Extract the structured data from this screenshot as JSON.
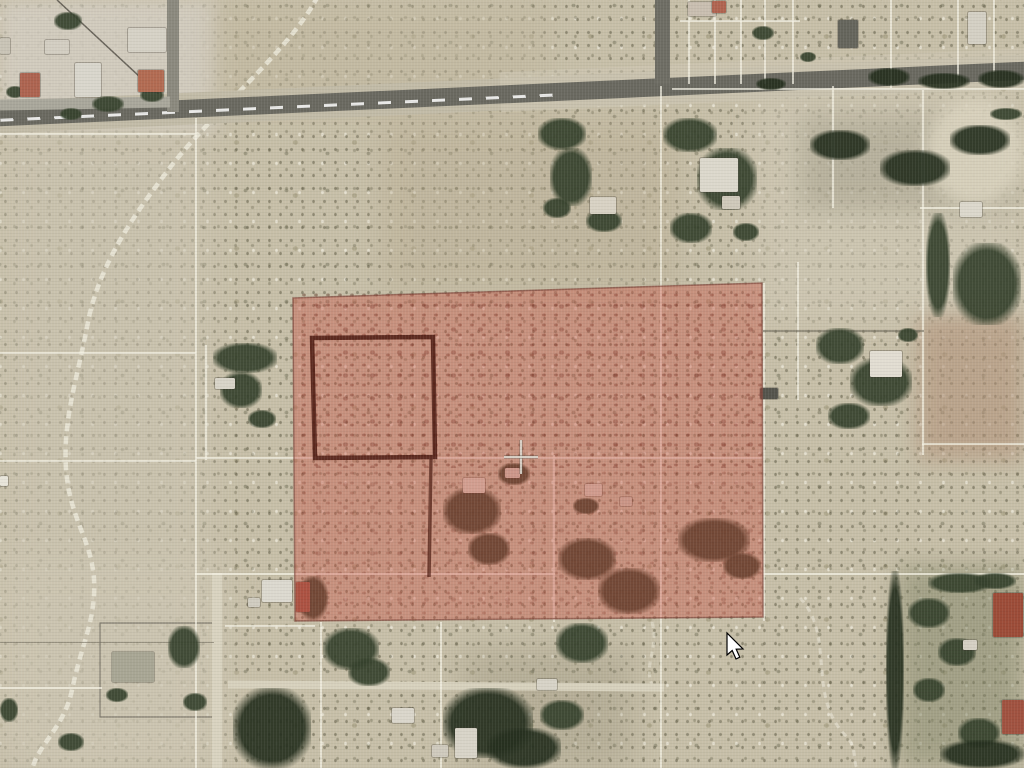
{
  "screen": {
    "width": 1024,
    "height": 768
  },
  "map": {
    "colors": {
      "desert_base": "#c7bfa8",
      "road": "#6a6960",
      "road_shoulder": "#c2bba7",
      "parcel_line": "#f4f1e3",
      "parcel_line_dark": "#6f6a5c",
      "tree": "#36422d",
      "tree_dark": "#26301f",
      "wash": "#ebe7d8",
      "selection_fill": "#c7483a",
      "selection_stroke": "#7a4036",
      "bold_outline": "#4a190f",
      "crosshair_light": "#f5f3ea",
      "crosshair_dark": "#4a483f",
      "cursor_fill": "#ffffff",
      "cursor_stroke": "#000000"
    },
    "patches": [
      [
        0,
        0,
        218,
        132,
        "#d3cdc0",
        0.9,
        8,
        0,
        0
      ],
      [
        210,
        0,
        340,
        118,
        "#c1b79e",
        0.5,
        12,
        0,
        0
      ],
      [
        0,
        128,
        212,
        645,
        "#ccc5b2",
        0.55,
        16,
        0,
        0
      ],
      [
        380,
        118,
        300,
        175,
        "#b8ab90",
        0.4,
        14,
        0,
        0
      ],
      [
        755,
        88,
        270,
        235,
        "#d1cab7",
        0.55,
        16,
        0,
        0
      ],
      [
        800,
        115,
        215,
        95,
        "#8a8672",
        0.3,
        12,
        0,
        0
      ],
      [
        918,
        315,
        106,
        145,
        "#b2937a",
        0.6,
        10,
        0,
        0
      ],
      [
        925,
        98,
        100,
        108,
        "#dcd5c0",
        0.85,
        8,
        1,
        0
      ],
      [
        898,
        566,
        126,
        202,
        "#7f8365",
        0.5,
        12,
        0,
        0
      ],
      [
        462,
        648,
        170,
        120,
        "#97917a",
        0.35,
        16,
        0,
        0
      ],
      [
        0,
        556,
        232,
        212,
        "#cfc8b4",
        0.45,
        16,
        0,
        0
      ],
      [
        298,
        290,
        464,
        178,
        "",
        0.85,
        0,
        0,
        1
      ],
      [
        298,
        468,
        464,
        150,
        "",
        0.55,
        0,
        0,
        1
      ]
    ],
    "roads": [
      {
        "x": -10,
        "y": 78,
        "w": 1044,
        "h": 32,
        "c": "#c2bba7",
        "rot": -2.6
      },
      {
        "x": 500,
        "y": 60,
        "w": 540,
        "h": 40,
        "c": "#cdc6b2",
        "rot": -2.6,
        "op": 0.6
      },
      {
        "x": -10,
        "y": 84.5,
        "w": 1044,
        "h": 18,
        "c": "#6a6960",
        "rot": -2.6
      },
      {
        "x": 0,
        "y": 105.5,
        "w": 560,
        "h": 3,
        "rot": -2.6,
        "dash": true
      },
      {
        "x": 655,
        "y": 0,
        "w": 15,
        "h": 84,
        "c": "#6e6d64"
      },
      {
        "x": 167,
        "y": 0,
        "w": 12,
        "h": 112,
        "c": "#8b897e"
      },
      {
        "x": 0,
        "y": 98,
        "w": 170,
        "h": 11,
        "c": "#a9a79b",
        "rot": -1
      },
      {
        "x": 228,
        "y": 682,
        "w": 436,
        "h": 8,
        "c": "#d7d1bd",
        "rot": 0.4
      },
      {
        "x": 212,
        "y": 573,
        "w": 10,
        "h": 195,
        "c": "#d9d3c0"
      }
    ],
    "parcel_lines": [
      [
        195,
        118,
        1.5,
        650,
        "l"
      ],
      [
        660,
        86,
        1.5,
        682,
        "l"
      ],
      [
        553,
        455,
        1.5,
        167,
        "l"
      ],
      [
        763,
        283,
        1.5,
        338,
        "l"
      ],
      [
        797,
        262,
        1.5,
        138,
        "l"
      ],
      [
        922,
        90,
        1.5,
        365,
        "l"
      ],
      [
        832,
        86,
        1.5,
        122,
        "l"
      ],
      [
        688,
        0,
        1.5,
        84,
        "l"
      ],
      [
        714,
        0,
        1.5,
        84,
        "l"
      ],
      [
        740,
        0,
        1.5,
        84,
        "l"
      ],
      [
        764,
        0,
        1.5,
        84,
        "l"
      ],
      [
        792,
        0,
        1.5,
        84,
        "l"
      ],
      [
        890,
        0,
        1.5,
        88,
        "l"
      ],
      [
        957,
        0,
        1.5,
        86,
        "l"
      ],
      [
        993,
        0,
        1.5,
        86,
        "l"
      ],
      [
        320,
        622,
        1.5,
        146,
        "l"
      ],
      [
        440,
        622,
        1.5,
        146,
        "l"
      ],
      [
        205,
        345,
        1.5,
        115,
        "l"
      ],
      [
        0,
        133,
        196,
        1.5,
        "l"
      ],
      [
        0,
        352,
        196,
        1.5,
        "l"
      ],
      [
        0,
        460,
        196,
        1.5,
        "l"
      ],
      [
        196,
        457,
        567,
        1.5,
        "l"
      ],
      [
        195,
        573,
        360,
        1.5,
        "l"
      ],
      [
        763,
        573,
        261,
        1.5,
        "l"
      ],
      [
        672,
        88,
        352,
        1.5,
        "l"
      ],
      [
        680,
        20,
        120,
        1.5,
        "l"
      ],
      [
        920,
        207,
        104,
        1.5,
        "l"
      ],
      [
        922,
        443,
        102,
        1.5,
        "l"
      ],
      [
        225,
        625,
        90,
        1.5,
        "l"
      ],
      [
        0,
        687,
        102,
        1.5,
        "l"
      ],
      [
        763,
        330,
        161,
        1.5,
        "d"
      ],
      [
        0,
        642,
        214,
        1,
        "d"
      ]
    ],
    "trees": [
      [
        54,
        12,
        28,
        18,
        0
      ],
      [
        92,
        96,
        32,
        16,
        0
      ],
      [
        140,
        88,
        24,
        14,
        0
      ],
      [
        6,
        86,
        18,
        12,
        0
      ],
      [
        60,
        108,
        22,
        12,
        0
      ],
      [
        213,
        343,
        64,
        30,
        0
      ],
      [
        220,
        372,
        42,
        36,
        0
      ],
      [
        248,
        410,
        28,
        18,
        0
      ],
      [
        538,
        118,
        48,
        32,
        0
      ],
      [
        550,
        148,
        42,
        58,
        0
      ],
      [
        586,
        210,
        36,
        22,
        0
      ],
      [
        543,
        198,
        28,
        20,
        0
      ],
      [
        663,
        118,
        54,
        34,
        0
      ],
      [
        697,
        148,
        60,
        62,
        0
      ],
      [
        670,
        213,
        42,
        30,
        0
      ],
      [
        733,
        223,
        26,
        18,
        0
      ],
      [
        816,
        328,
        48,
        36,
        0
      ],
      [
        850,
        358,
        62,
        48,
        0
      ],
      [
        828,
        403,
        42,
        26,
        0
      ],
      [
        898,
        328,
        20,
        14,
        0
      ],
      [
        926,
        213,
        24,
        104,
        0
      ],
      [
        953,
        243,
        68,
        82,
        0
      ],
      [
        990,
        108,
        32,
        12,
        0
      ],
      [
        868,
        68,
        42,
        18,
        1
      ],
      [
        918,
        73,
        52,
        16,
        1
      ],
      [
        978,
        70,
        46,
        18,
        1
      ],
      [
        756,
        78,
        30,
        12,
        1
      ],
      [
        810,
        130,
        60,
        30,
        1
      ],
      [
        880,
        150,
        70,
        36,
        1
      ],
      [
        950,
        125,
        60,
        30,
        1
      ],
      [
        443,
        488,
        58,
        46,
        0
      ],
      [
        468,
        533,
        42,
        32,
        0
      ],
      [
        498,
        463,
        32,
        22,
        0
      ],
      [
        558,
        538,
        58,
        42,
        0
      ],
      [
        598,
        568,
        62,
        46,
        0
      ],
      [
        573,
        498,
        26,
        16,
        0
      ],
      [
        678,
        518,
        72,
        44,
        0
      ],
      [
        723,
        553,
        38,
        26,
        0
      ],
      [
        323,
        628,
        56,
        42,
        0
      ],
      [
        348,
        658,
        42,
        28,
        0
      ],
      [
        556,
        623,
        52,
        40,
        0
      ],
      [
        443,
        688,
        90,
        70,
        1
      ],
      [
        487,
        728,
        74,
        40,
        1
      ],
      [
        540,
        700,
        44,
        30,
        0
      ],
      [
        168,
        626,
        32,
        42,
        0
      ],
      [
        183,
        693,
        24,
        18,
        0
      ],
      [
        106,
        688,
        22,
        14,
        0
      ],
      [
        58,
        733,
        26,
        18,
        0
      ],
      [
        0,
        698,
        18,
        24,
        0
      ],
      [
        233,
        688,
        78,
        80,
        1
      ],
      [
        298,
        576,
        30,
        44,
        0
      ],
      [
        886,
        571,
        18,
        197,
        1
      ],
      [
        908,
        598,
        42,
        30,
        0
      ],
      [
        938,
        638,
        38,
        28,
        0
      ],
      [
        913,
        678,
        32,
        24,
        0
      ],
      [
        958,
        718,
        42,
        30,
        0
      ],
      [
        928,
        573,
        64,
        20,
        0
      ],
      [
        974,
        573,
        42,
        16,
        0
      ],
      [
        940,
        740,
        84,
        28,
        1
      ],
      [
        752,
        26,
        22,
        14,
        0
      ],
      [
        800,
        52,
        16,
        10,
        0
      ]
    ],
    "buildings": [
      [
        20,
        73,
        20,
        24,
        "#ad6450"
      ],
      [
        45,
        40,
        24,
        14,
        "#d3cec2"
      ],
      [
        75,
        63,
        26,
        34,
        "#d9d6cc"
      ],
      [
        128,
        28,
        38,
        24,
        "#d6d2c6"
      ],
      [
        138,
        70,
        26,
        22,
        "#b26b52"
      ],
      [
        0,
        38,
        10,
        16,
        "#c9c4b6"
      ],
      [
        0,
        476,
        8,
        10,
        "#e8e5da"
      ],
      [
        688,
        2,
        28,
        14,
        "#c9beb0"
      ],
      [
        712,
        1,
        14,
        12,
        "#b06450"
      ],
      [
        838,
        20,
        20,
        28,
        "#65655c"
      ],
      [
        968,
        12,
        18,
        32,
        "#d4d0c4"
      ],
      [
        590,
        197,
        26,
        17,
        "#d8d2c4"
      ],
      [
        700,
        158,
        38,
        34,
        "#dcd8cc"
      ],
      [
        722,
        196,
        18,
        13,
        "#cfc9ba"
      ],
      [
        870,
        351,
        32,
        26,
        "#e2ddd2"
      ],
      [
        760,
        388,
        18,
        11,
        "#55544c"
      ],
      [
        960,
        202,
        22,
        15,
        "#dcd8cc"
      ],
      [
        215,
        378,
        20,
        11,
        "#d8d4c8"
      ],
      [
        463,
        478,
        22,
        15,
        "#d8d3c6"
      ],
      [
        505,
        468,
        15,
        10,
        "#cfc9bb"
      ],
      [
        585,
        484,
        17,
        12,
        "#d5cfc0"
      ],
      [
        620,
        497,
        12,
        9,
        "#ccc5b5"
      ],
      [
        296,
        582,
        14,
        30,
        "#9c5a48"
      ],
      [
        262,
        580,
        30,
        22,
        "#dcd9cf"
      ],
      [
        248,
        598,
        12,
        9,
        "#d0ccc0"
      ],
      [
        112,
        652,
        42,
        30,
        "#a8a694"
      ],
      [
        392,
        708,
        22,
        15,
        "#dad6cb"
      ],
      [
        455,
        728,
        22,
        30,
        "#d8d4c8"
      ],
      [
        432,
        745,
        16,
        12,
        "#cfcabd"
      ],
      [
        537,
        679,
        20,
        11,
        "#d7d3c7"
      ],
      [
        993,
        593,
        30,
        44,
        "#9c4c38"
      ],
      [
        1002,
        700,
        22,
        34,
        "#a05240"
      ],
      [
        963,
        640,
        14,
        10,
        "#d5d0c4"
      ]
    ],
    "wash_paths": [
      {
        "d": "M318,-4 C290,50 215,110 172,165 C140,207 100,260 88,322 C77,380 63,418 66,468 C69,518 92,540 94,580 C96,620 82,642 72,690 C64,728 38,744 32,770",
        "w": 4.5,
        "dash": "8 5",
        "op": 0.85
      },
      {
        "d": "M800,598 C836,636 806,696 846,736 C858,748 852,762 858,770",
        "w": 3,
        "dash": "6 5",
        "op": 0.55
      },
      {
        "d": "M652,622 C660,650 640,668 655,690",
        "w": 3,
        "dash": "6 4",
        "op": 0.5
      }
    ],
    "boundary_segments": [
      [
        57,
        0,
        168,
        103
      ]
    ],
    "fences": [
      [
        100,
        623,
        120,
        94
      ]
    ],
    "selection": {
      "points": [
        [
          293,
          298
        ],
        [
          762,
          283
        ],
        [
          763,
          617
        ],
        [
          295,
          621
        ]
      ],
      "fill_opacity": 0.38,
      "stroke_opacity": 0.65
    },
    "inner_square": {
      "points": [
        [
          312,
          338
        ],
        [
          433,
          337
        ],
        [
          435,
          457
        ],
        [
          315,
          458
        ]
      ],
      "width": 4.5,
      "opacity": 0.85
    },
    "inner_line": {
      "x1": 431,
      "y1": 459,
      "x2": 429,
      "y2": 577,
      "width": 3.5,
      "opacity": 0.7
    },
    "crosshair": {
      "x": 521,
      "y": 457,
      "arm": 17
    },
    "cursor": {
      "x": 727,
      "y": 633,
      "path": "M0 0 L0 22 L5.2 17.5 L9 26 L12.8 24.2 L9.2 16.2 L16 16 Z"
    }
  }
}
